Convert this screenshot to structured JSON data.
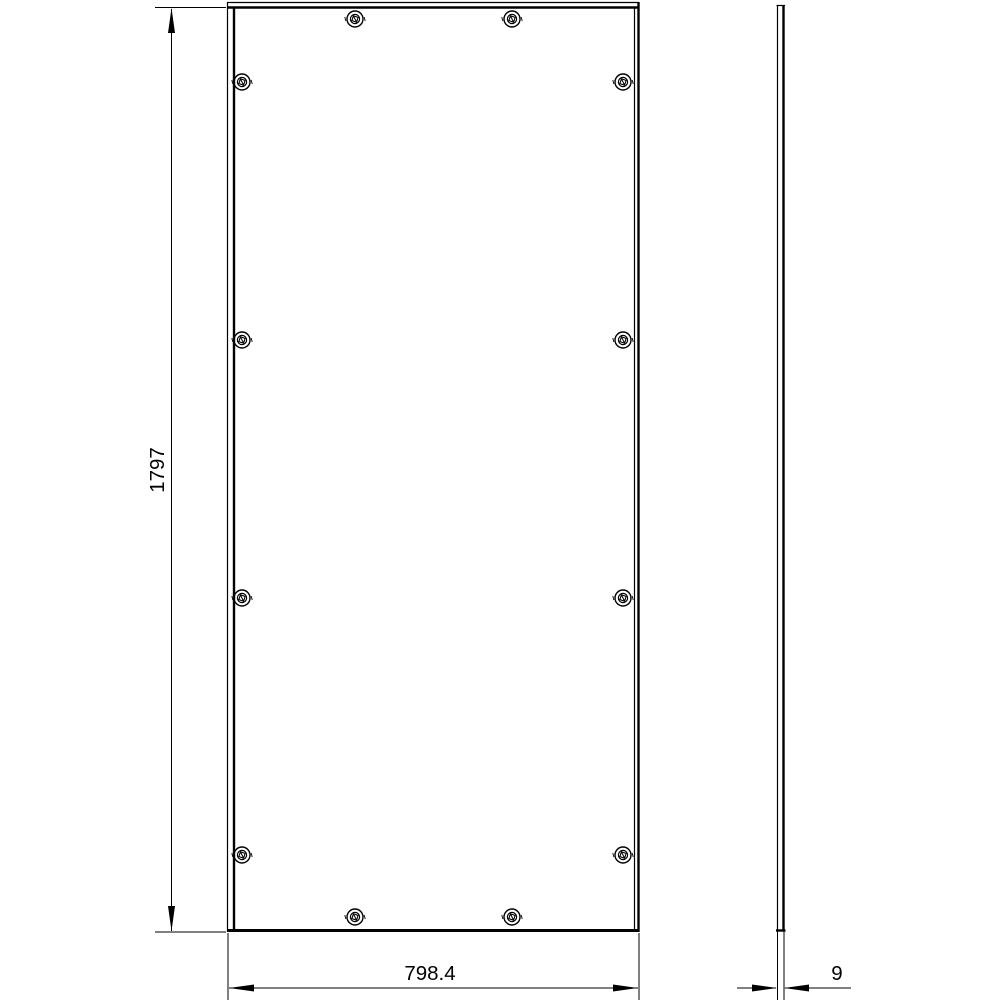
{
  "page": {
    "background_color": "#ffffff",
    "ink_color": "#000000",
    "title": "panel-technical-drawing"
  },
  "drawing": {
    "type": "technical-drawing",
    "views": [
      {
        "id": "front",
        "label": "front-view-panel"
      },
      {
        "id": "side",
        "label": "side-profile-view"
      }
    ],
    "dimensions": {
      "height": {
        "value": "1797",
        "orientation": "vertical"
      },
      "width": {
        "value": "798.4",
        "orientation": "horizontal"
      },
      "thickness": {
        "value": "9",
        "orientation": "horizontal"
      }
    },
    "screws": [
      {
        "x": 355,
        "y": 19
      },
      {
        "x": 512,
        "y": 19
      },
      {
        "x": 242,
        "y": 82
      },
      {
        "x": 623,
        "y": 82
      },
      {
        "x": 242,
        "y": 340
      },
      {
        "x": 623,
        "y": 340
      },
      {
        "x": 242,
        "y": 598
      },
      {
        "x": 623,
        "y": 598
      },
      {
        "x": 242,
        "y": 855
      },
      {
        "x": 623,
        "y": 855
      },
      {
        "x": 355,
        "y": 917
      },
      {
        "x": 512,
        "y": 917
      }
    ]
  }
}
